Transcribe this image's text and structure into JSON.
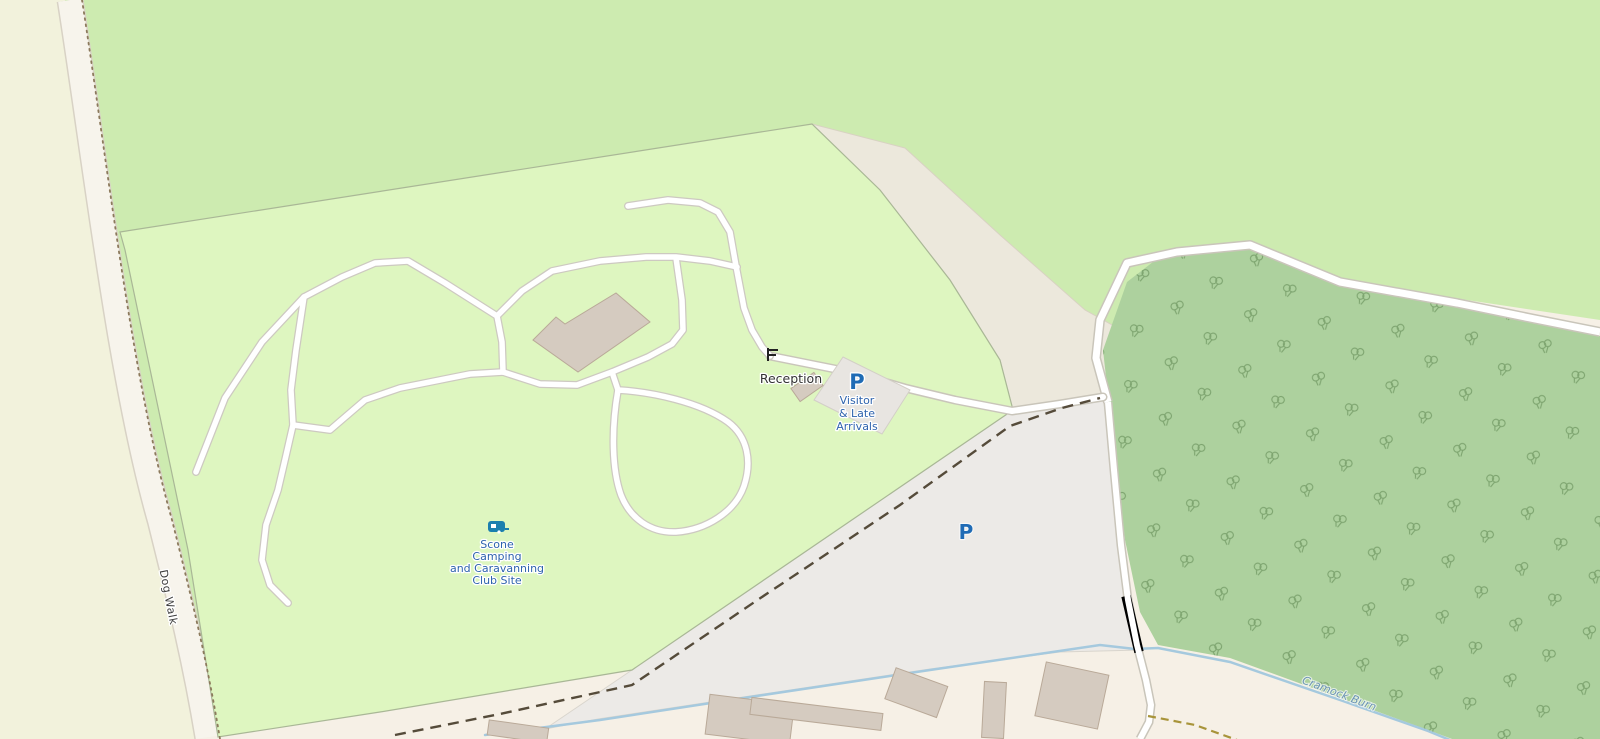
{
  "map": {
    "description": "OpenStreetMap-style rendering of a camp site area",
    "labels": {
      "dog_walk": "Dog Walk",
      "reception": "Reception",
      "campsite": {
        "lines": [
          "Scone",
          "Camping",
          "and Caravanning",
          "Club Site"
        ]
      },
      "visitor_parking": {
        "p": "P",
        "lines": [
          "Visitor",
          "& Late",
          "Arrivals"
        ]
      },
      "overflow_parking": {
        "p": "P"
      },
      "stream": "Cramock Burn"
    },
    "icons": {
      "campsite": "caravan-icon",
      "visitor_parking": "parking-letter-icon",
      "overflow_parking": "parking-letter-icon",
      "entrance": "gate-icon",
      "stream_crossing": "bridge-icon",
      "woodland": "deciduous-tree-icon"
    },
    "colors": {
      "meadow": "#cdebb0",
      "farmland": "#f2f2dc",
      "campsite": "#def6c0",
      "campsite_border": "#a9b796",
      "woodland": "#add19e",
      "tree_symbol": "#7da46f",
      "road_fill": "#ffffff",
      "road_casing": "#c9c5ba",
      "path_casing": "#cdc9c1",
      "track_strip": "#f7f4ec",
      "track_strip_edge": "#d8d2c5",
      "gray_area": "#eceae7",
      "gray_area_edge": "#d9d5cd",
      "beige_area": "#ece8dc",
      "beige_area_edge": "#d8d2c2",
      "cream_area": "#f6f0e6",
      "building_fill": "#d5cbc0",
      "building_stroke": "#b9a998",
      "parking_lot_fill": "#e8e5e1",
      "parking_lot_stroke": "#d3cfc7",
      "water": "#a5c9de",
      "dashed_track": "#554b3a",
      "minor_track": "#a8943a",
      "dotted_path": "#8c7a5c",
      "label_dark": "#3d3d3d",
      "label_building": "#333333",
      "label_blue": "#2e63ad",
      "p_blue": "#1f6bb5",
      "water_label": "#6b94b5",
      "caravan_icon": "#1b7fae",
      "gate_icon": "#222222"
    }
  }
}
